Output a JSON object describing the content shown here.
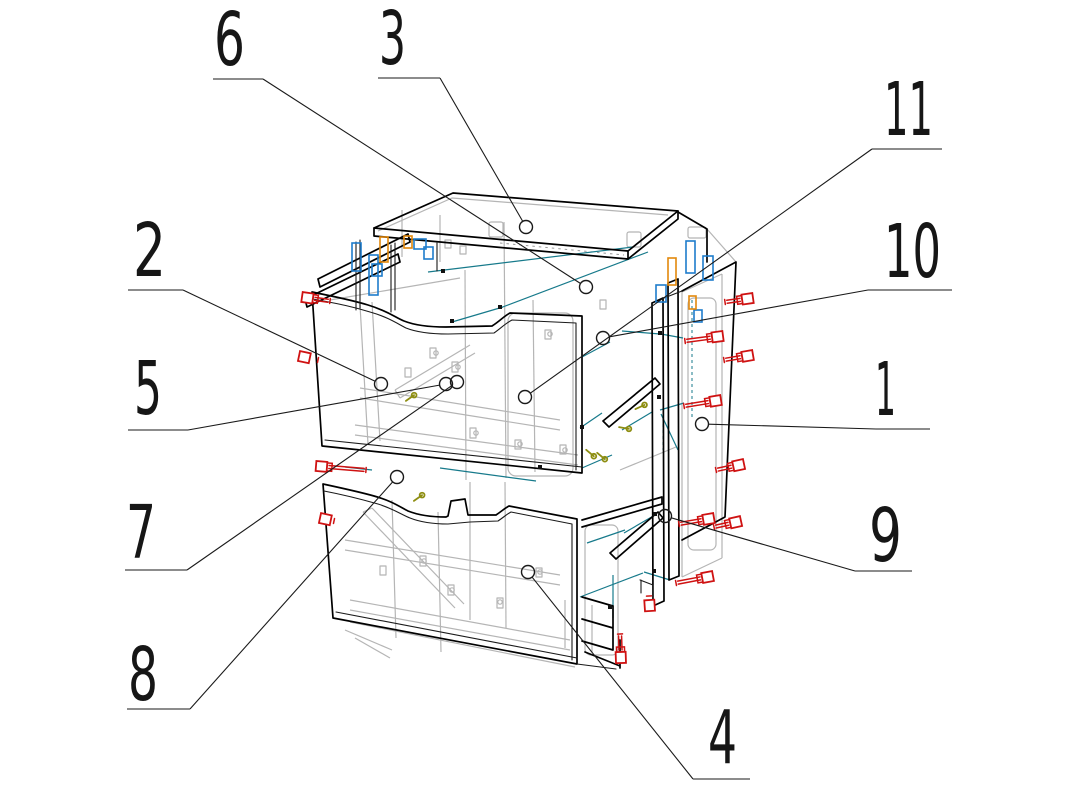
{
  "figure": {
    "width": 1087,
    "height": 792,
    "background": "#ffffff",
    "kind": "exploded-assembly-drawing",
    "subject": "two-drawer cabinet exploded view with numbered part callouts"
  },
  "palette": {
    "outline": "#000000",
    "hidden_lines": "#b5b5b5",
    "guide_teal": "#177a8b",
    "fastener_red": "#cf1212",
    "hardware_blue": "#1e7ccb",
    "hardware_orange": "#e2880c",
    "screw_olive": "#8e8e12",
    "text": "#161616"
  },
  "callouts": [
    {
      "label": "1",
      "tx": 875,
      "ty": 415,
      "tlen": 21,
      "underline": [
        876,
        429,
        930,
        429
      ],
      "leader": [
        876,
        429,
        702,
        424
      ],
      "balloon": [
        702,
        424
      ]
    },
    {
      "label": "2",
      "tx": 133,
      "ty": 276,
      "tlen": 33,
      "underline": [
        128,
        290,
        183,
        290
      ],
      "leader": [
        183,
        290,
        381,
        384
      ],
      "balloon": [
        381,
        384
      ]
    },
    {
      "label": "3",
      "tx": 379,
      "ty": 64,
      "tlen": 27,
      "underline": [
        378,
        78,
        440,
        78
      ],
      "leader": [
        440,
        78,
        526,
        227
      ],
      "balloon": [
        526,
        227
      ]
    },
    {
      "label": "4",
      "tx": 708,
      "ty": 763,
      "tlen": 29,
      "underline": [
        693,
        779,
        750,
        779
      ],
      "leader": [
        693,
        779,
        528,
        572
      ],
      "balloon": [
        528,
        572
      ]
    },
    {
      "label": "5",
      "tx": 134,
      "ty": 414,
      "tlen": 28,
      "underline": [
        128,
        430,
        188,
        430
      ],
      "leader": [
        188,
        430,
        446,
        384
      ],
      "balloon": [
        446,
        384
      ]
    },
    {
      "label": "6",
      "tx": 214,
      "ty": 65,
      "tlen": 31,
      "underline": [
        213,
        79,
        263,
        79
      ],
      "leader": [
        263,
        79,
        586,
        287
      ],
      "balloon": [
        586,
        287
      ]
    },
    {
      "label": "7",
      "tx": 126,
      "ty": 558,
      "tlen": 30,
      "underline": [
        125,
        570,
        187,
        570
      ],
      "leader": [
        187,
        570,
        457,
        382
      ],
      "balloon": [
        457,
        382
      ]
    },
    {
      "label": "8",
      "tx": 128,
      "ty": 700,
      "tlen": 30,
      "underline": [
        127,
        709,
        190,
        709
      ],
      "leader": [
        190,
        709,
        397,
        477
      ],
      "balloon": [
        397,
        477
      ]
    },
    {
      "label": "9",
      "tx": 869,
      "ty": 561,
      "tlen": 33,
      "underline": [
        855,
        571,
        912,
        571
      ],
      "leader": [
        855,
        571,
        665,
        516
      ],
      "balloon": [
        665,
        516
      ]
    },
    {
      "label": "10",
      "tx": 884,
      "ty": 277,
      "tlen": 57,
      "underline": [
        868,
        290,
        952,
        290
      ],
      "leader": [
        868,
        290,
        603,
        338
      ],
      "balloon": [
        603,
        338
      ]
    },
    {
      "label": "11",
      "tx": 884,
      "ty": 135,
      "tlen": 49,
      "underline": [
        872,
        149,
        942,
        149
      ],
      "leader": [
        872,
        149,
        525,
        397
      ],
      "balloon": [
        525,
        397
      ]
    }
  ],
  "balloon_radius": 6.5,
  "label_font_size": 74,
  "drawing": {
    "black_bold_paths": [
      "M374,228 L453,193 L678,211 L628,251 Z",
      "M374,228 L374,236 L628,259 L628,251",
      "M628,259 L678,219 L678,211",
      "M678,212 L707,229 L707,262",
      "M408,234 L318,279 M410,242 L320,287 M318,279 L320,287 M408,234 L410,242",
      "M398,254 L305,299 M400,262 L307,307 M305,299 L307,307 M398,254 L400,262",
      "M312,292 C336,297 352,300 368,305 C388,311 396,318 404,321 C414,325 428,327 446,327 L492,326 C500,321 504,316 510,313 L582,316 L582,473 L322,446 Z",
      "M323,484 C346,489 360,492 374,496 C392,501 400,507 408,511 C418,515 430,517 446,517 L448,516 L451,501 L465,499 L468,515 L496,515 C502,511 505,508 509,506 L577,519 L577,664 L333,618 Z",
      "M652,303 L663,298 M652,303 L653,606 M663,298 L664,601 M653,606 L664,601",
      "M668,283 L678,279 M668,283 L669,580 M678,279 L679,576 M669,580 L679,576",
      "M682,291 L736,262 L725,517 L682,540",
      "M582,520 L662,497 M582,527 L662,504 M662,497 L662,504",
      "M603,421 L655,378 M609,427 L660,384 M655,378 L660,384 M603,421 L609,427",
      "M610,553 L658,512 M616,559 L663,518 M658,512 L663,518 M610,553 L616,559",
      "M582,597 L613,606 M582,619 L613,628 M582,641 L613,650 M613,606 L613,650 M585,652 L620,666 M620,640 L620,668"
    ],
    "black_thin_paths": [
      "M313,299 C340,304 354,307 370,312 C388,317 398,324 406,328 C416,332 430,334 448,334 L494,333 C501,328 506,323 512,320 L576,323 L576,470",
      "M325,440 L582,467",
      "M324,491 C350,496 364,500 378,504 C394,509 402,515 410,518 C420,522 432,524 448,524 L470,522 L498,521 C504,517 507,514 511,512 L572,524 L572,660",
      "M336,612 L577,658",
      "M356,242 L356,310 M360,240 L360,308",
      "M391,245 L391,312 M395,243 L395,310",
      "M437,243 L437,271",
      "M664,298 L682,291",
      "M577,664 L616,669",
      "M640,580 L653,585 L653,598 M641,580 L641,593"
    ],
    "gray_paths": [
      "M378,231 L452,198 L668,215",
      "M707,229 L736,262",
      "M682,292 L682,577 M722,274 L722,558 M682,292 L722,274 M682,577 L722,558",
      "M465,270 L466,480",
      "M504,222 L506,478",
      "M440,215 L440,262",
      "M402,210 L402,257",
      "M533,300 L535,472",
      "M470,482 L470,620",
      "M505,482 L506,628",
      "M360,388 L560,420 M360,398 L560,430 M355,425 L578,455 M355,435 L578,465",
      "M360,305 L368,444 M372,302 L380,441",
      "M395,390 L470,345 M400,398 L475,353 M395,390 L400,398",
      "M345,540 L560,575 M345,550 L560,585 M350,600 L570,640 M350,610 L570,650",
      "M363,512 L455,608 M372,508 L464,604 M363,512 L372,508",
      "M392,500 L396,638 M438,512 L441,652",
      "M350,622 L575,667 M345,630 L392,650",
      "M355,638 L390,658",
      "M330,300 L460,278",
      "M620,470 L676,447",
      "M565,600 L565,648 M592,605 L592,652"
    ],
    "gray_dashed_paths": [
      "M500,243 L624,255"
    ],
    "gray_rects": [
      {
        "x": 489,
        "y": 222,
        "w": 14,
        "h": 15,
        "r": 2
      },
      {
        "x": 627,
        "y": 232,
        "w": 14,
        "h": 15,
        "r": 2
      },
      {
        "x": 688,
        "y": 227,
        "w": 18,
        "h": 11,
        "r": 2
      },
      {
        "x": 508,
        "y": 313,
        "w": 65,
        "h": 163,
        "r": 8
      },
      {
        "x": 688,
        "y": 298,
        "w": 28,
        "h": 252,
        "r": 6
      },
      {
        "x": 585,
        "y": 525,
        "w": 33,
        "h": 130,
        "r": 6
      }
    ],
    "gray_fittings_rects": [
      [
        430,
        348,
        6,
        10
      ],
      [
        452,
        362,
        6,
        10
      ],
      [
        470,
        428,
        6,
        10
      ],
      [
        515,
        440,
        6,
        9
      ],
      [
        405,
        368,
        6,
        9
      ],
      [
        420,
        556,
        6,
        10
      ],
      [
        448,
        585,
        6,
        10
      ],
      [
        497,
        598,
        6,
        10
      ],
      [
        536,
        568,
        6,
        9
      ],
      [
        380,
        566,
        6,
        9
      ],
      [
        545,
        330,
        6,
        9
      ],
      [
        560,
        445,
        6,
        9
      ],
      [
        600,
        300,
        6,
        9
      ],
      [
        445,
        240,
        6,
        8
      ],
      [
        460,
        246,
        6,
        8
      ]
    ],
    "gray_fittings_circles": [
      [
        436,
        353
      ],
      [
        458,
        367
      ],
      [
        476,
        433
      ],
      [
        520,
        444
      ],
      [
        424,
        561
      ],
      [
        452,
        590
      ],
      [
        500,
        602
      ],
      [
        540,
        572
      ],
      [
        565,
        450
      ],
      [
        550,
        334
      ]
    ],
    "teal_segments": [
      [
        633,
        247,
        428,
        272
      ],
      [
        648,
        252,
        500,
        308
      ],
      [
        503,
        307,
        452,
        322
      ],
      [
        660,
        334,
        622,
        331
      ],
      [
        683,
        338,
        661,
        334
      ],
      [
        652,
        412,
        622,
        430
      ],
      [
        661,
        414,
        678,
        450
      ],
      [
        655,
        515,
        624,
        533
      ],
      [
        580,
        428,
        602,
        413
      ],
      [
        582,
        468,
        612,
        455
      ],
      [
        440,
        468,
        536,
        481
      ],
      [
        345,
        467,
        372,
        470
      ],
      [
        587,
        543,
        625,
        530
      ],
      [
        610,
        342,
        582,
        357
      ],
      [
        684,
        403,
        660,
        410
      ],
      [
        613,
        575,
        613,
        618
      ],
      [
        644,
        572,
        670,
        580
      ],
      [
        580,
        597,
        643,
        573
      ]
    ],
    "teal_dashed_segments": [
      [
        663,
        340,
        663,
        450
      ],
      [
        692,
        300,
        692,
        420
      ]
    ],
    "black_dots": [
      [
        443,
        271
      ],
      [
        500,
        307
      ],
      [
        452,
        321
      ],
      [
        660,
        333
      ],
      [
        659,
        397
      ],
      [
        655,
        514
      ],
      [
        654,
        571
      ],
      [
        582,
        427
      ],
      [
        610,
        607
      ],
      [
        540,
        467
      ]
    ],
    "olive_marks": [
      [
        410,
        398,
        -35
      ],
      [
        590,
        453,
        40
      ],
      [
        601,
        456,
        40
      ],
      [
        640,
        407,
        -25
      ],
      [
        624,
        428,
        10
      ],
      [
        418,
        498,
        -35
      ]
    ],
    "hardware_blue_rects": [
      [
        352,
        243,
        9,
        28
      ],
      [
        369,
        255,
        9,
        40
      ],
      [
        414,
        239,
        12,
        10
      ],
      [
        424,
        247,
        9,
        12
      ],
      [
        372,
        264,
        10,
        12
      ],
      [
        686,
        241,
        9,
        32
      ],
      [
        703,
        256,
        10,
        24
      ],
      [
        656,
        285,
        10,
        17
      ],
      [
        694,
        310,
        8,
        12
      ]
    ],
    "hardware_orange_rects": [
      [
        380,
        237,
        8,
        25
      ],
      [
        404,
        236,
        8,
        12
      ],
      [
        668,
        258,
        8,
        27
      ],
      [
        689,
        296,
        7,
        13
      ]
    ],
    "screws": [
      {
        "tip": [
          725,
          302
        ],
        "head": [
          753,
          298
        ]
      },
      {
        "tip": [
          685,
          341
        ],
        "head": [
          723,
          336
        ]
      },
      {
        "tip": [
          724,
          360
        ],
        "head": [
          753,
          355
        ]
      },
      {
        "tip": [
          684,
          406
        ],
        "head": [
          721,
          400
        ]
      },
      {
        "tip": [
          716,
          470
        ],
        "head": [
          744,
          464
        ]
      },
      {
        "tip": [
          679,
          524
        ],
        "head": [
          714,
          518
        ]
      },
      {
        "tip": [
          714,
          527
        ],
        "head": [
          741,
          521
        ]
      },
      {
        "tip": [
          676,
          583
        ],
        "head": [
          713,
          576
        ]
      },
      {
        "tip": [
          330,
          301
        ],
        "head": [
          302,
          297
        ]
      },
      {
        "tip": [
          318,
          360
        ],
        "head": [
          299,
          356
        ]
      },
      {
        "tip": [
          366,
          470
        ],
        "head": [
          316,
          466
        ]
      },
      {
        "tip": [
          334,
          521
        ],
        "head": [
          320,
          518
        ]
      },
      {
        "tip": [
          620,
          634
        ],
        "head": [
          621,
          663
        ]
      },
      {
        "tip": [
          649,
          596
        ],
        "head": [
          650,
          611
        ]
      }
    ]
  }
}
